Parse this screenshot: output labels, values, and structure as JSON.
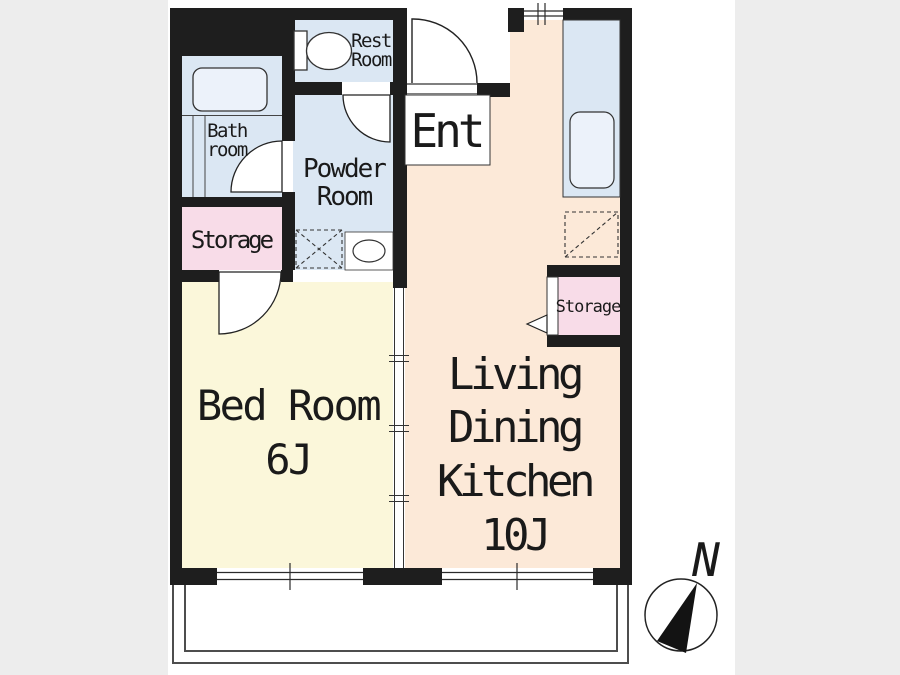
{
  "colors": {
    "background": "#ededed",
    "paper": "#ffffff",
    "wall": "#1e1e1e",
    "wet_room": "#dbe7f3",
    "storage": "#f8dce8",
    "bedroom": "#fbf7da",
    "ldk": "#fce9d8",
    "fixture": "#ecf2fa",
    "white": "#ffffff"
  },
  "rooms": {
    "rest_room": {
      "label_line1": "Rest",
      "label_line2": "Room"
    },
    "bath_room": {
      "label_line1": "Bath",
      "label_line2": "room"
    },
    "powder_room": {
      "label_line1": "Powder",
      "label_line2": "Room"
    },
    "entrance": {
      "label": "Ent"
    },
    "storage_left": {
      "label": "Storage"
    },
    "storage_right": {
      "label": "Storage"
    },
    "bed_room": {
      "label": "Bed Room",
      "size": "6J"
    },
    "living_dining_kitchen": {
      "label_line1": "Living",
      "label_line2": "Dining",
      "label_line3": "Kitchen",
      "size": "10J"
    }
  },
  "compass": {
    "north_label": "N"
  }
}
